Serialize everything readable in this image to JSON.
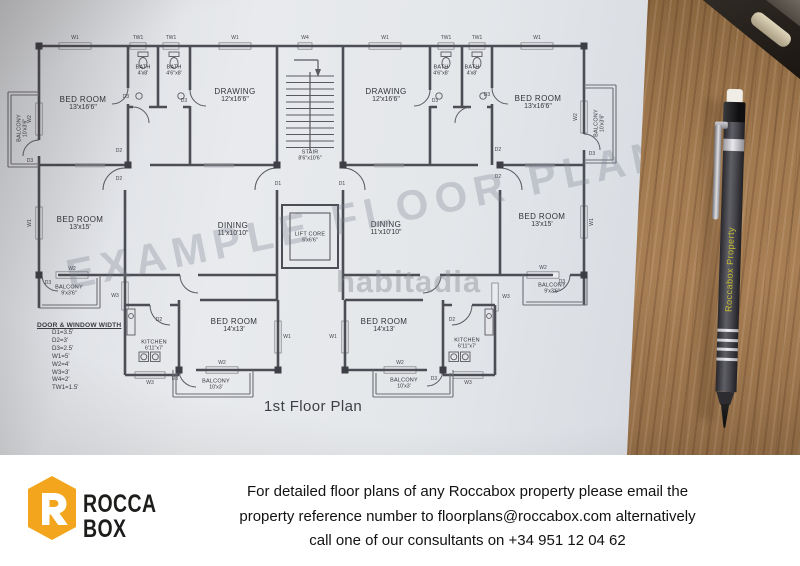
{
  "plan": {
    "title": "1st Floor Plan",
    "watermark_diagonal": "EXAMPLE FLOOR PLAN",
    "watermark_brand": "habitadia",
    "legend": {
      "title": "DOOR & WINDOW WIDTH",
      "items": [
        "D1=3.5'",
        "D2=3'",
        "D3=2.5'",
        "W1=5'",
        "W2=4'",
        "W3=3'",
        "W4=2'",
        "TW1=1.5'"
      ]
    },
    "rooms": [
      {
        "name": "BED ROOM",
        "dims": "13'x16'6\""
      },
      {
        "name": "BATH",
        "dims": "4'x8'"
      },
      {
        "name": "BATH",
        "dims": "4'6\"x8'"
      },
      {
        "name": "DRAWING",
        "dims": "12'x16'6\""
      },
      {
        "name": "STAIR",
        "dims": "8'6\"x10'6\""
      },
      {
        "name": "DRAWING",
        "dims": "12'x16'6\""
      },
      {
        "name": "BATH",
        "dims": "4'6\"x8'"
      },
      {
        "name": "BATH",
        "dims": "4'x8'"
      },
      {
        "name": "BED ROOM",
        "dims": "13'x16'6\""
      },
      {
        "name": "BALCONY",
        "dims": "10'x3'6\""
      },
      {
        "name": "BALCONY",
        "dims": "10'x3'6\""
      },
      {
        "name": "BED ROOM",
        "dims": "13'x15'"
      },
      {
        "name": "DINING",
        "dims": "11'x10'10\""
      },
      {
        "name": "LIFT CORE",
        "dims": "6'x6'6\""
      },
      {
        "name": "DINING",
        "dims": "11'x10'10\""
      },
      {
        "name": "BED ROOM",
        "dims": "13'x15'"
      },
      {
        "name": "BALCONY",
        "dims": "9'x3'6\""
      },
      {
        "name": "BALCONY",
        "dims": "9'x3'6\""
      },
      {
        "name": "KITCHEN",
        "dims": "6'11\"x7'"
      },
      {
        "name": "KITCHEN",
        "dims": "6'11\"x7'"
      },
      {
        "name": "BED ROOM",
        "dims": "14'x13'"
      },
      {
        "name": "BED ROOM",
        "dims": "14'x13'"
      },
      {
        "name": "BALCONY",
        "dims": "10'x3'"
      },
      {
        "name": "BALCONY",
        "dims": "10'x3'"
      }
    ],
    "labels": [
      "W1",
      "TW1",
      "TW1",
      "W1",
      "W4",
      "W1",
      "TW1",
      "TW1",
      "W1",
      "W2",
      "W1",
      "W2",
      "W1",
      "D3",
      "D3",
      "D3",
      "D3",
      "D3",
      "D3",
      "D2",
      "D2",
      "D1",
      "D1",
      "D2",
      "D2",
      "W2",
      "D3",
      "W3",
      "W2",
      "D3",
      "W3",
      "D2",
      "D2",
      "W3",
      "W3",
      "W1",
      "W1",
      "W2",
      "W2",
      "D3",
      "D3"
    ]
  },
  "pen": {
    "brand_text": "Roccabox Property"
  },
  "footer": {
    "logo": {
      "line1": "ROCCA",
      "line2": "BOX",
      "hex_color": "#F2A51D"
    },
    "message": {
      "line1": "For detailed floor plans of any Roccabox property please email the",
      "line2": "property reference number to floorplans@roccabox.com alternatively",
      "line3": "call one of our consultants on +34 951 12 04 62"
    }
  }
}
